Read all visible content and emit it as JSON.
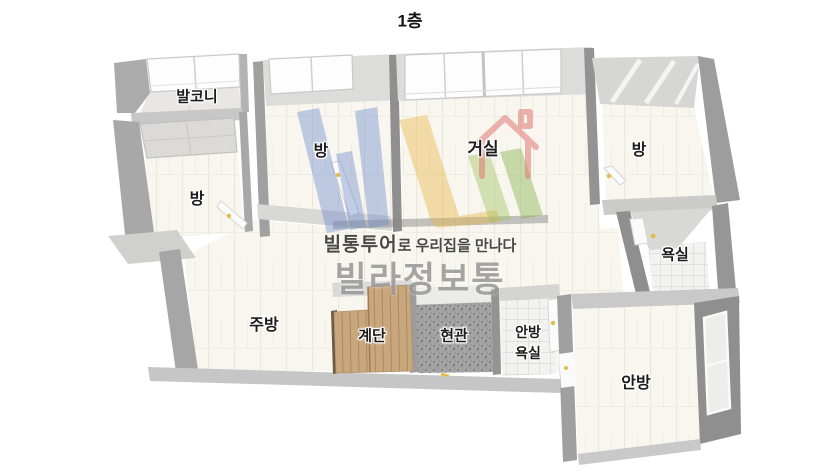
{
  "title": "1층",
  "rooms": {
    "balcony": {
      "label": "발코니"
    },
    "room_left": {
      "label": "방"
    },
    "room_center": {
      "label": "방"
    },
    "living": {
      "label": "거실"
    },
    "room_right": {
      "label": "방"
    },
    "bathroom": {
      "label": "욕실"
    },
    "kitchen": {
      "label": "주방"
    },
    "stairs": {
      "label": "계단"
    },
    "entrance": {
      "label": "현관"
    },
    "master_bathroom": {
      "label_line1": "안방",
      "label_line2": "욕실"
    },
    "master_bedroom": {
      "label": "안방"
    }
  },
  "watermark": {
    "tagline_brand": "빌통투어",
    "tagline_rest": "로 우리집을 만나다",
    "brand": "빌라정보통"
  },
  "colors": {
    "label_text": "#1c1c1c",
    "wall_dark": "#9b9b9b",
    "wall_light": "#d6d6d4",
    "floor": "#f8f6ee",
    "wood": "#c9a77d",
    "entry_floor": "#a4a4a4",
    "logo_blue": "#6e8ccd",
    "logo_yellow": "#e9b542",
    "logo_green": "#8cb950",
    "logo_red": "#e07874",
    "brand_gray": "#8e8e8e"
  }
}
